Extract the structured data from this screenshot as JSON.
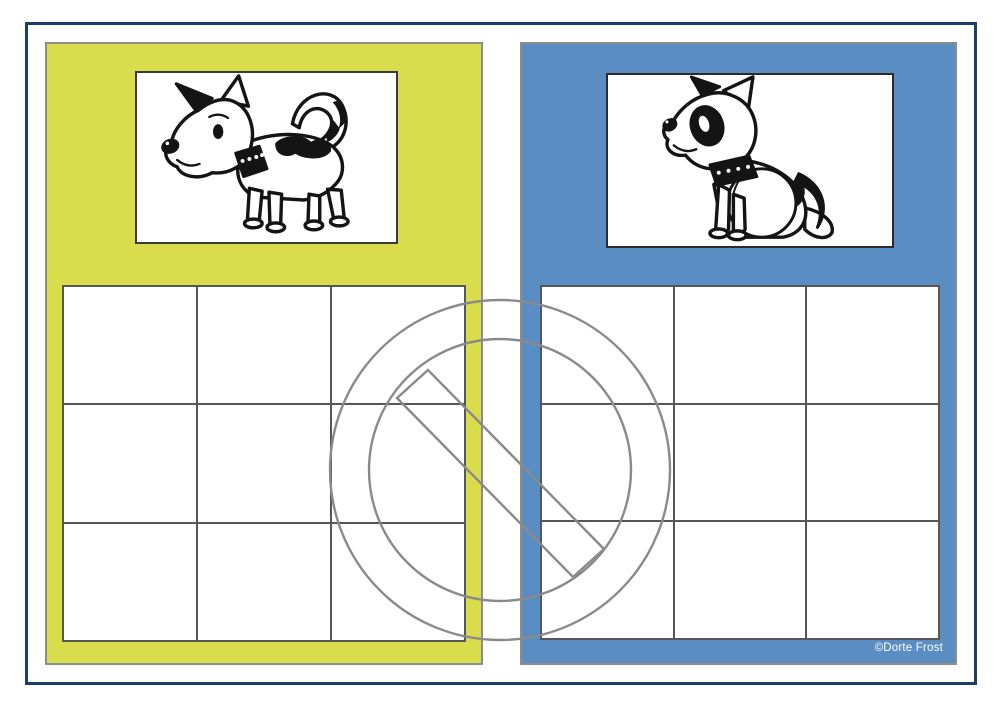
{
  "page": {
    "copyright": "©Dorte Frost"
  },
  "colors": {
    "page_bg": "#ffffff",
    "frame_navy": "#1c3e66",
    "panel_left_bg": "#d9dc4b",
    "panel_right_bg": "#5a8dc1",
    "panel_border_gray": "#8c8c8c",
    "grid_line": "#565656",
    "card_border_left": "#3a3a3a",
    "card_border_right": "#2b2b2b",
    "watermark_gray": "#8a8a8a",
    "copyright_text": "#ffffff"
  },
  "panels": [
    {
      "id": "left",
      "color_name": "yellow-green",
      "card": {
        "image": "standing-dog",
        "description": "black and white cartoon puppy standing, facing left, with black ear, studded collar, spot on back and curled tail"
      },
      "grid": {
        "rows": 3,
        "cols": 3
      }
    },
    {
      "id": "right",
      "color_name": "blue",
      "card": {
        "image": "sitting-dog",
        "description": "black and white cartoon puppy sitting, facing up-left, with black eye patch, studded collar and black patch on haunch"
      },
      "grid": {
        "rows": 3,
        "cols": 3
      }
    }
  ],
  "watermark": {
    "icon": "no-copy-watermark",
    "shape": "prohibition-sign-outline"
  }
}
